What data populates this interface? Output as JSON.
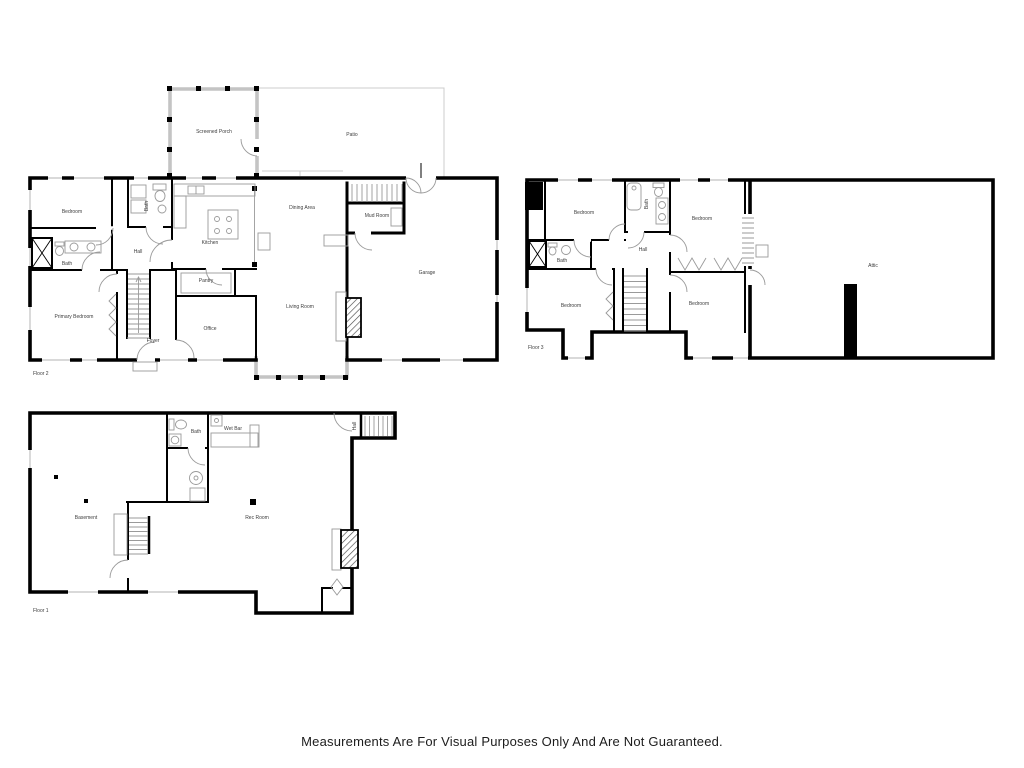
{
  "disclaimer": "Measurements Are For Visual Purposes Only And Are Not Guaranteed.",
  "floor2": {
    "label": "Floor 2",
    "rooms": {
      "screened_porch": "Screened Porch",
      "patio": "Patio",
      "bedroom": "Bedroom",
      "bath_upper": "Bath",
      "kitchen": "Kitchen",
      "dining_area": "Dining Area",
      "mud_room": "Mud Room",
      "bath": "Bath",
      "hall": "Hall",
      "pantry": "Pantry",
      "primary_bedroom": "Primary Bedroom",
      "office": "Office",
      "foyer": "Foyer",
      "living_room": "Living Room",
      "garage": "Garage"
    }
  },
  "floor3": {
    "label": "Floor 3",
    "rooms": {
      "bedroom_nw": "Bedroom",
      "bath_upper": "Bath",
      "bedroom_ne": "Bedroom",
      "bath": "Bath",
      "hall": "Hall",
      "bedroom_sw": "Bedroom",
      "bedroom_se": "Bedroom",
      "attic": "Attic"
    }
  },
  "floor1": {
    "label": "Floor 1",
    "rooms": {
      "basement": "Basement",
      "bath": "Bath",
      "wet_bar": "Wet Bar",
      "rec_room": "Rec Room",
      "hall": "Hall"
    }
  },
  "colors": {
    "wall": "#000000",
    "window_gray": "#c2c2c2",
    "porch_gray": "#c4c4c4",
    "fixture_gray": "#9a9a9a",
    "label_text": "#3d3d3d"
  }
}
